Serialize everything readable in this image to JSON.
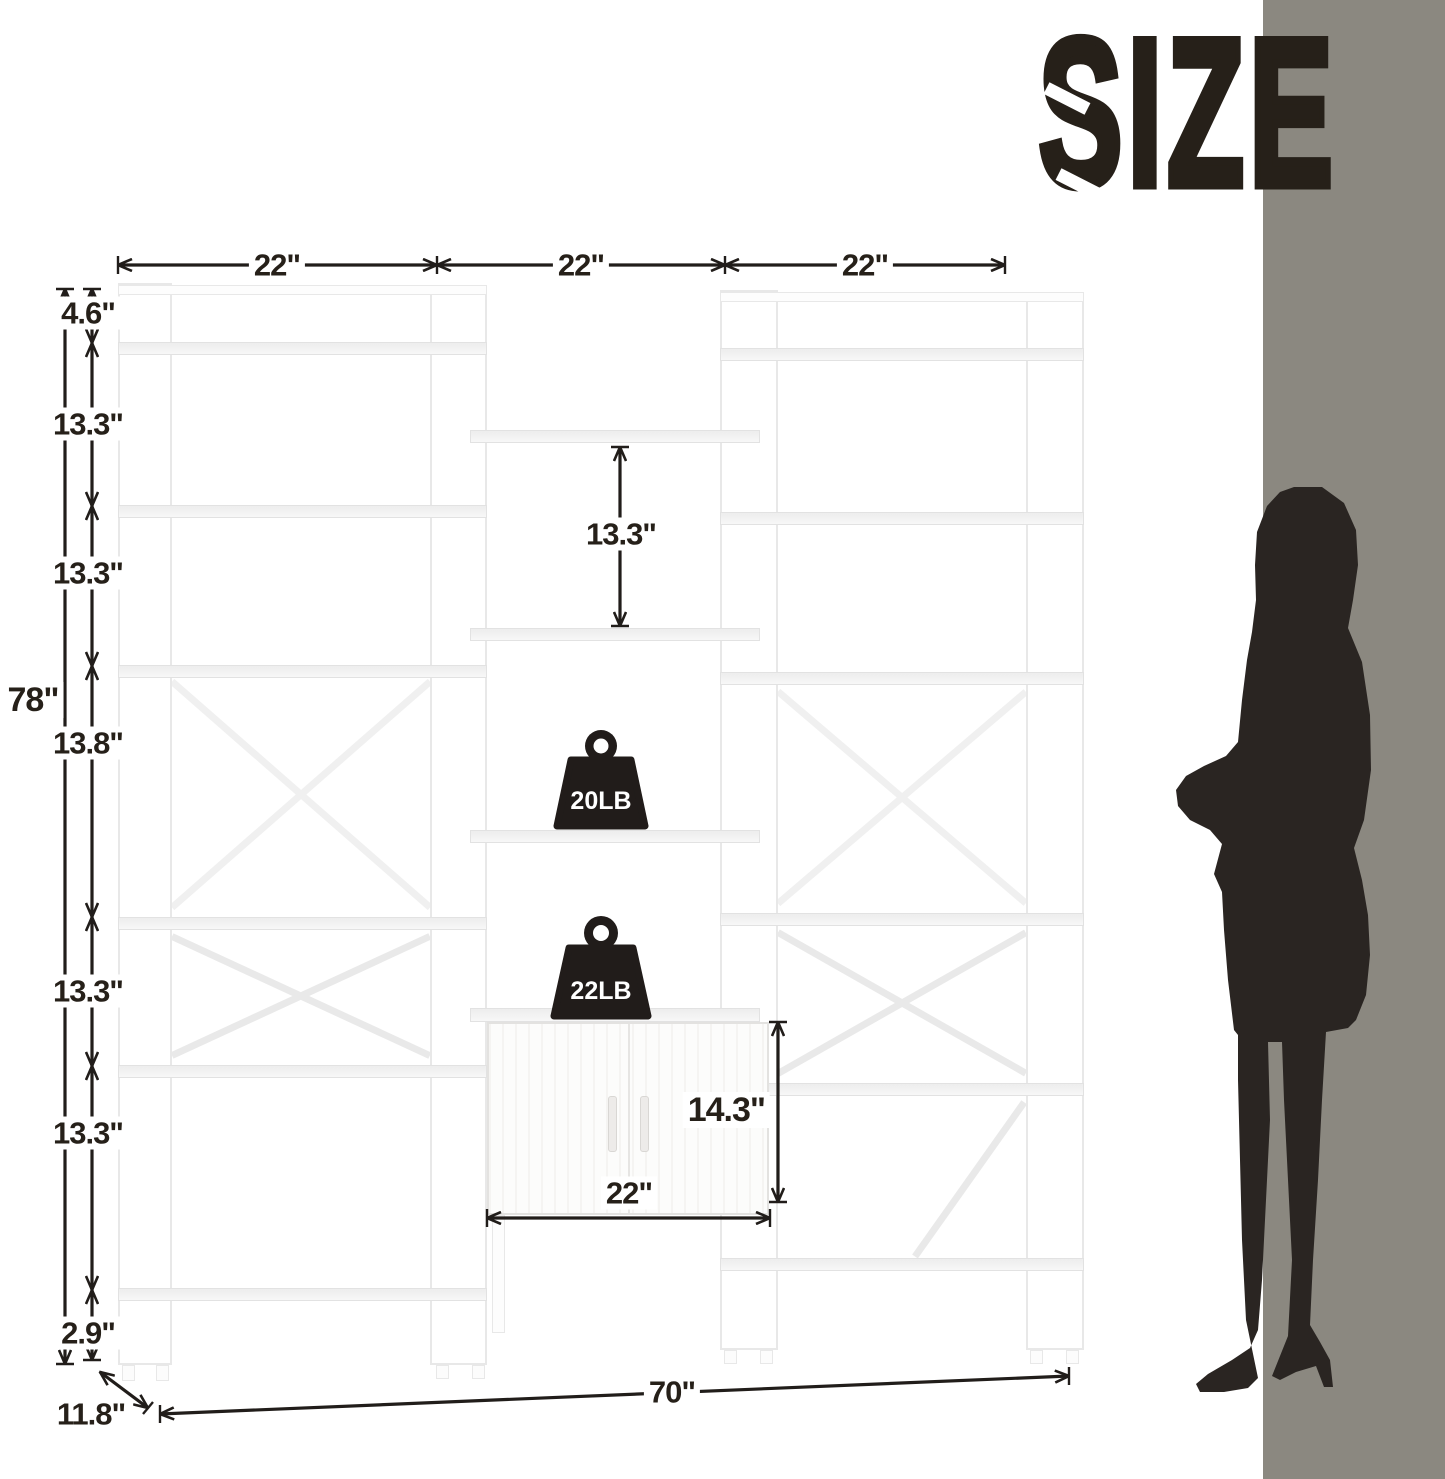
{
  "title": "SIZE",
  "colors": {
    "wall": "#8b8880",
    "ink": "#262019",
    "line": "#211d1a",
    "silhouette": "#2a2522"
  },
  "dims": {
    "top_widths": [
      "22\"",
      "22\"",
      "22\""
    ],
    "overall_height": "78\"",
    "left_chain": [
      "4.6\"",
      "13.3\"",
      "13.3\"",
      "13.8\"",
      "13.3\"",
      "13.3\"",
      "2.9\""
    ],
    "middle_shelf_gap": "13.3\"",
    "cabinet_height": "14.3\"",
    "cabinet_width": "22\"",
    "overall_width": "70\"",
    "depth": "11.8\""
  },
  "capacity": {
    "shelf_label": "20LB",
    "cabinet_label": "22LB"
  }
}
